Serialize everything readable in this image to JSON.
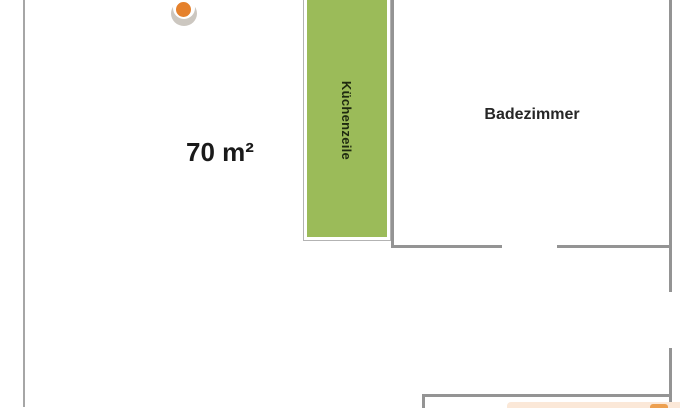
{
  "labels": {
    "area": "70 m²",
    "kitchen_unit": "Küchenzeile",
    "bathroom": "Badezimmer"
  },
  "colors": {
    "wall-gray": "#949494",
    "outer-wall-gray": "#a6a6a6",
    "kitchen-green": "#9bbb59",
    "shape-border-gray": "#b3b3b3",
    "dot-orange": "#e5812c",
    "dot-shadow": "#ccc7c0",
    "accent-peach": "#fbe8d8",
    "accent-orange": "#eda050",
    "text-dark": "#262626"
  }
}
